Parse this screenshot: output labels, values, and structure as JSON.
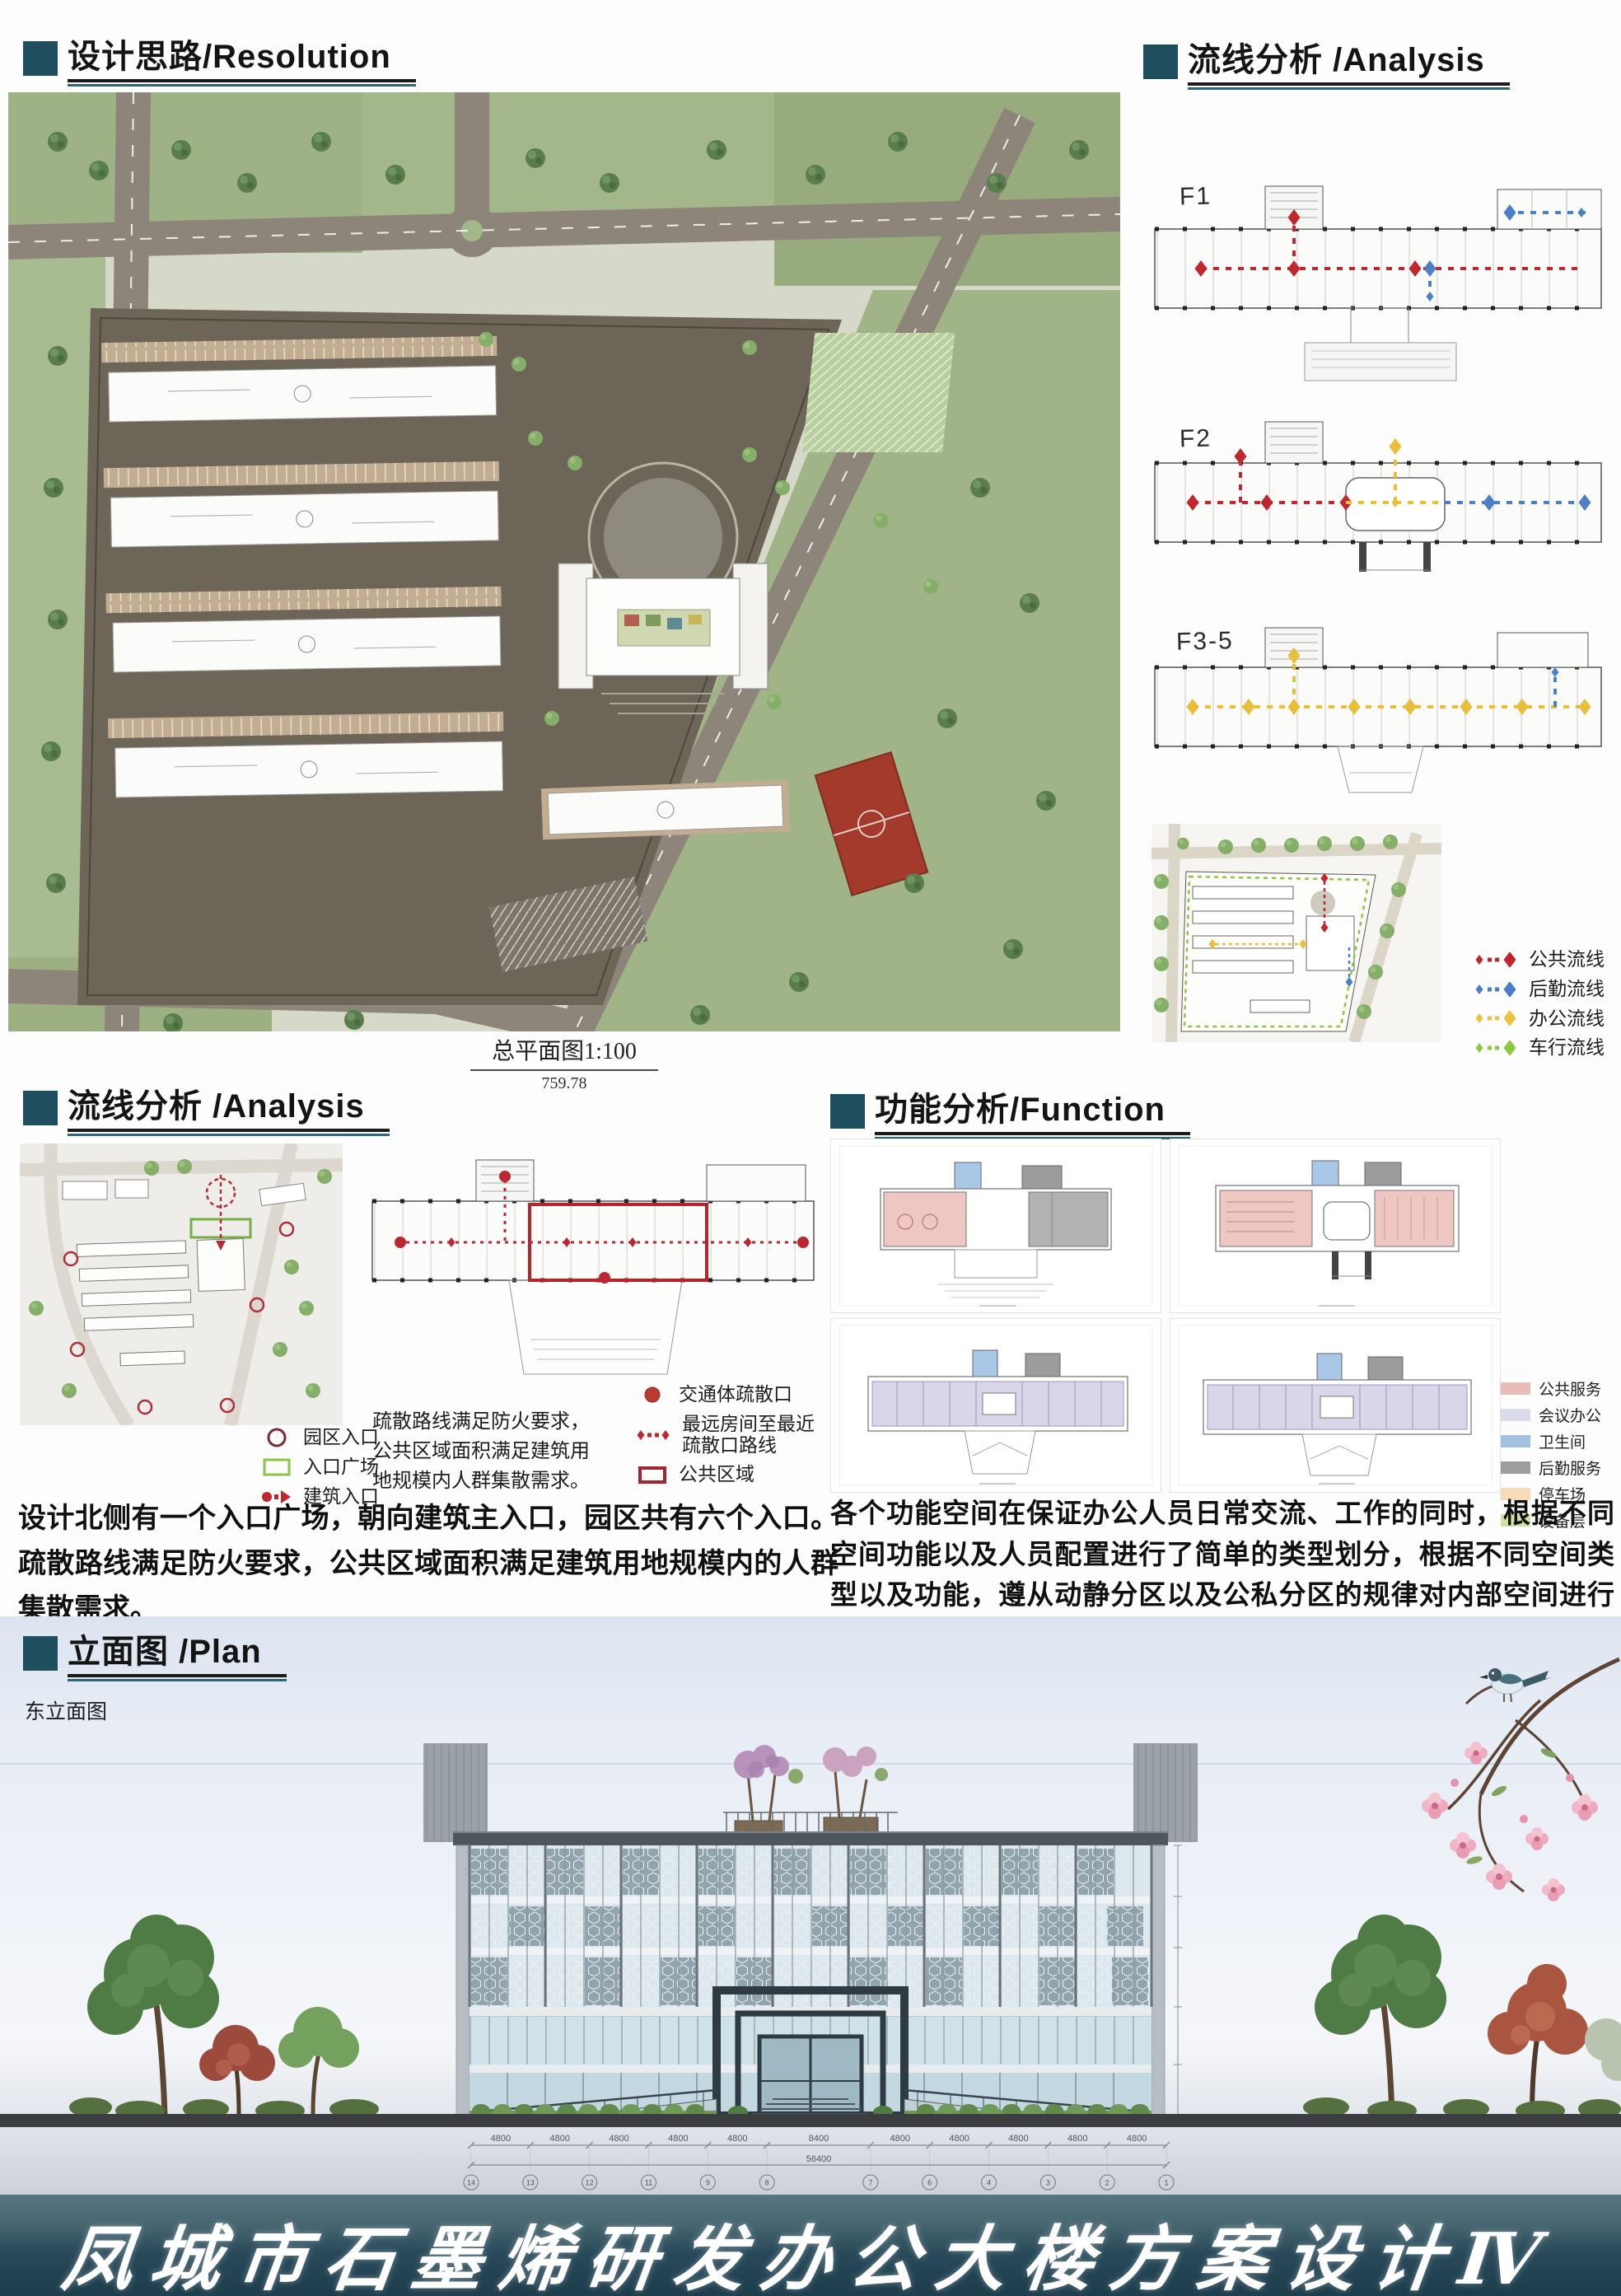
{
  "colors": {
    "accent_teal": "#1f4e5e",
    "public_red": "#c0272d",
    "logistics_blue": "#4a7cc7",
    "office_yellow": "#eec13e",
    "vehicle_green": "#8dc63f"
  },
  "headers": {
    "resolution": "设计思路/Resolution",
    "flow_right": "流线分析 /Analysis",
    "flow_left": "流线分析 /Analysis",
    "function": "功能分析/Function",
    "elevation": "立面图 /Plan"
  },
  "master_plan": {
    "caption": "总平面图1:100",
    "scale_note": "759.78"
  },
  "flow_right": {
    "floor_labels": [
      "F1",
      "F2",
      "F3-5"
    ],
    "legend": [
      {
        "label": "公共流线",
        "color": "#c0272d"
      },
      {
        "label": "后勤流线",
        "color": "#4a7cc7"
      },
      {
        "label": "办公流线",
        "color": "#eec13e"
      },
      {
        "label": "车行流线",
        "color": "#8dc63f"
      }
    ]
  },
  "flow_left": {
    "entry_legend": [
      {
        "label": "园区入口",
        "color": "#7a2b33"
      },
      {
        "label": "入口广场",
        "color": "#8cc43f"
      },
      {
        "label": "建筑入口",
        "color": "#c0272d"
      }
    ],
    "evac_legend": [
      {
        "label": "交通体疏散口",
        "color": "#bb3a30"
      },
      {
        "label": "最远房间至最近\n疏散口路线",
        "color": "#c0272d"
      },
      {
        "label": "公共区域",
        "color": "#a52430"
      }
    ],
    "evac_note": "疏散路线满足防火要求，\n公共区域面积满足建筑用\n地规模内人群集散需求。",
    "paragraph": "设计北侧有一个入口广场，朝向建筑主入口，园区共有六个入口。疏散路线满足防火要求，公共区域面积满足建筑用地规模内的人群集散需求。"
  },
  "function": {
    "legend": [
      {
        "label": "公共服务",
        "color": "#e9bcb8"
      },
      {
        "label": "会议办公",
        "color": "#d9dcec"
      },
      {
        "label": "卫生间",
        "color": "#a3c2e2"
      },
      {
        "label": "后勤服务",
        "color": "#9d9d9d"
      },
      {
        "label": "停车场",
        "color": "#f6dbb9"
      },
      {
        "label": "设备层",
        "color": "#cfe2a3"
      }
    ],
    "paragraph": "各个功能空间在保证办公人员日常交流、工作的同时，根据不同空间功能以及人员配置进行了简单的类型划分，根据不同空间类型以及功能，遵从动静分区以及公私分区的规律对内部空间进行了设计。"
  },
  "elevation": {
    "label": "东立面图",
    "dims": [
      "4800",
      "4800",
      "4800",
      "4800",
      "4800",
      "8400",
      "4800",
      "4800",
      "4800",
      "4800",
      "4800"
    ],
    "total": "56400",
    "grid_bubbles": [
      "14",
      "13",
      "12",
      "11",
      "9",
      "8",
      "7",
      "6",
      "4",
      "3",
      "2",
      "1"
    ]
  },
  "footer": {
    "title": "凤城市石墨烯研发办公大楼方案设计",
    "numeral": "Ⅳ"
  }
}
